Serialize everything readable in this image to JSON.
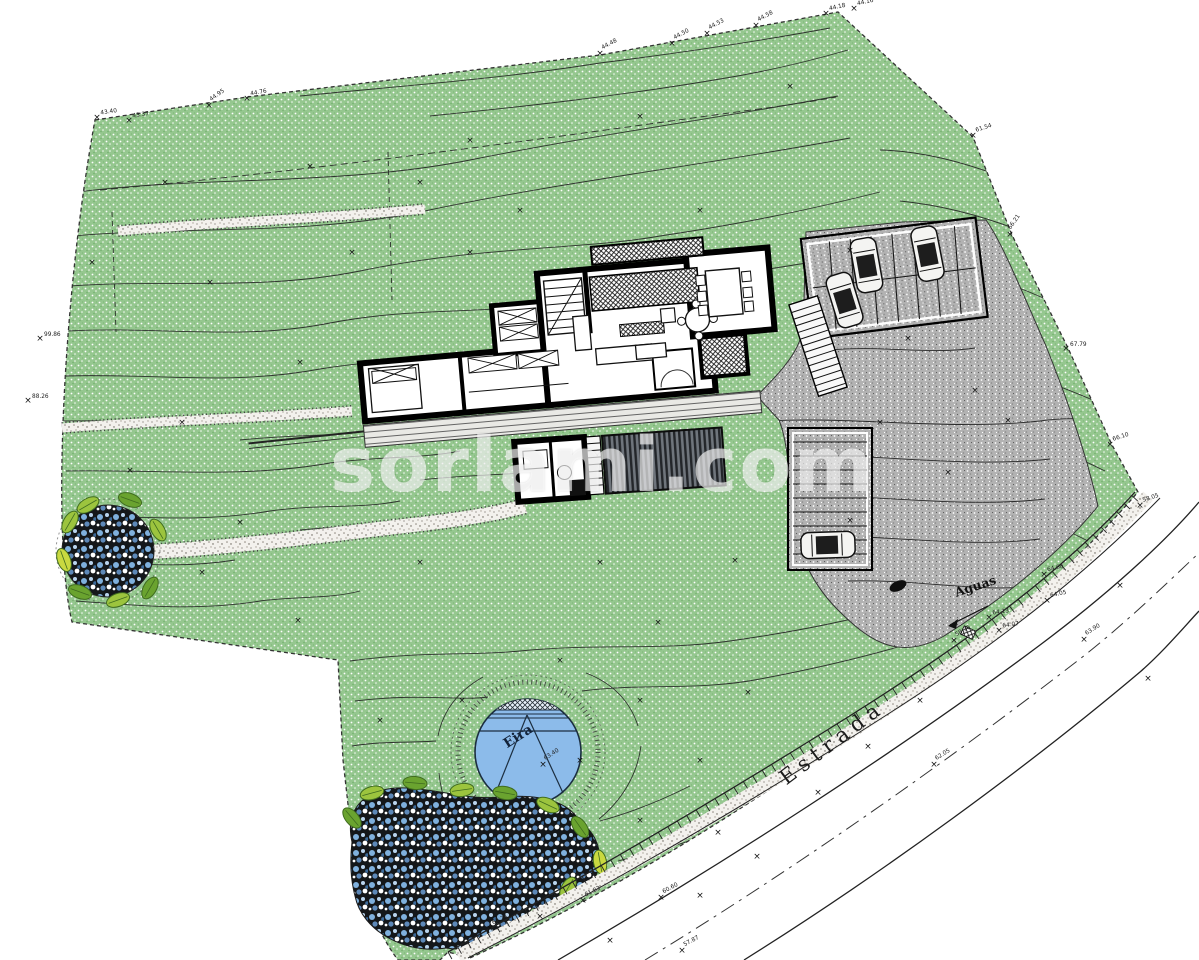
{
  "watermark": {
    "text": "sorlami.com"
  },
  "labels": {
    "eira": "Eira",
    "estrada": "Estrada",
    "aguas": "Aguas"
  },
  "colors": {
    "site_green": "#95c78f",
    "paving_gray": "#b2b2b2",
    "water_blue": "#8cbbea",
    "planting_dark": "#14171a",
    "leaf_green": "#9cc43e",
    "line_dark": "#1c1c1c"
  },
  "elevation_markers": [
    [
      97,
      117,
      "43.40",
      -8
    ],
    [
      129,
      120,
      "43.37",
      -8
    ],
    [
      209,
      105,
      "44.95",
      -35
    ],
    [
      247,
      98,
      "44.76",
      -10
    ],
    [
      600,
      53,
      "44.48",
      -28
    ],
    [
      672,
      43,
      "44.50",
      -28
    ],
    [
      707,
      33,
      "44.53",
      -28
    ],
    [
      756,
      25,
      "44.58",
      -28
    ],
    [
      826,
      13,
      "44.18",
      -12
    ],
    [
      854,
      8,
      "44.16",
      -12
    ],
    [
      973,
      135,
      "61.54",
      -18
    ],
    [
      1010,
      234,
      "66.21",
      -55
    ],
    [
      1066,
      348,
      "67.79",
      0
    ],
    [
      1110,
      444,
      "66.10",
      -18
    ],
    [
      1140,
      505,
      "58.05",
      -18
    ],
    [
      40,
      338,
      "99.86",
      0
    ],
    [
      28,
      400,
      "88.26",
      0
    ],
    [
      1044,
      574,
      "64.60",
      -12
    ],
    [
      1047,
      600,
      "64.05",
      -12
    ],
    [
      989,
      617,
      "64.13",
      -8
    ],
    [
      999,
      630,
      "64.07",
      -8
    ],
    [
      954,
      640,
      "58.36",
      -30
    ],
    [
      934,
      764,
      "62.05",
      -32
    ],
    [
      1084,
      639,
      "63.90",
      -32
    ],
    [
      490,
      928,
      "62.74",
      -24
    ],
    [
      583,
      900,
      "61.83",
      -26
    ],
    [
      661,
      897,
      "60.60",
      -28
    ],
    [
      682,
      950,
      "57.87",
      -28
    ],
    [
      543,
      764,
      "63.40",
      -33
    ],
    [
      920,
      700,
      "",
      -32
    ],
    [
      1120,
      585,
      "",
      -20
    ],
    [
      1148,
      678,
      "",
      -32
    ],
    [
      868,
      746,
      "",
      -32
    ],
    [
      818,
      792,
      "",
      -32
    ],
    [
      757,
      856,
      "",
      -30
    ],
    [
      700,
      895,
      "",
      -28
    ],
    [
      540,
      916,
      "",
      -24
    ],
    [
      610,
      940,
      "",
      -26
    ]
  ],
  "survey_crosses": [
    [
      165,
      182
    ],
    [
      310,
      166
    ],
    [
      470,
      140
    ],
    [
      640,
      116
    ],
    [
      790,
      86
    ],
    [
      210,
      282
    ],
    [
      352,
      252
    ],
    [
      300,
      362
    ],
    [
      182,
      422
    ],
    [
      240,
      522
    ],
    [
      420,
      562
    ],
    [
      298,
      620
    ],
    [
      600,
      562
    ],
    [
      658,
      622
    ],
    [
      735,
      560
    ],
    [
      560,
      660
    ],
    [
      640,
      700
    ],
    [
      748,
      692
    ],
    [
      850,
      520
    ],
    [
      948,
      472
    ],
    [
      880,
      422
    ],
    [
      1008,
      420
    ],
    [
      700,
      760
    ],
    [
      640,
      820
    ],
    [
      580,
      760
    ],
    [
      462,
      700
    ],
    [
      380,
      720
    ],
    [
      718,
      832
    ],
    [
      202,
      572
    ],
    [
      130,
      470
    ],
    [
      92,
      262
    ],
    [
      420,
      182
    ],
    [
      520,
      210
    ],
    [
      700,
      210
    ],
    [
      850,
      250
    ],
    [
      908,
      338
    ],
    [
      975,
      390
    ],
    [
      470,
      252
    ]
  ]
}
